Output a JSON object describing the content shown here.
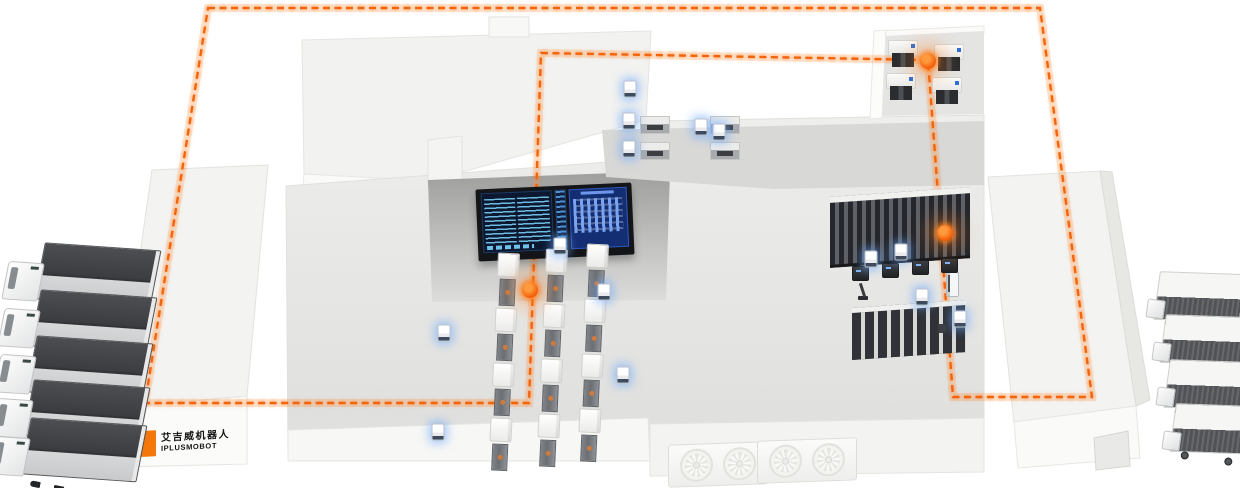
{
  "scene": {
    "width": 1240,
    "height": 488,
    "background": "#ffffff"
  },
  "palette": {
    "route_orange": "#f4640a",
    "route_glow": "#ff8a2a",
    "agv_glow_blue": "#6aa7ff",
    "building_light": "#f3f3f1",
    "floor_gray": "#e6e6e4",
    "control_wall_gray": "#a2a2a0",
    "machine_dark": "#3a3d42",
    "screen_navy": "#0b1830",
    "screen_blue": "#142e74",
    "screen_cyan": "#6fc2ec",
    "logo_orange": "#f4770b"
  },
  "logo": {
    "icon": "orange-blocks-logo",
    "line1": "艾吉威机器人",
    "line2": "IPLUSMOBOT"
  },
  "route": {
    "closed": true,
    "dash_pattern": "7 4.5",
    "points": [
      [
        208,
        8
      ],
      [
        1040,
        8
      ],
      [
        1092,
        397
      ],
      [
        953,
        397
      ],
      [
        928,
        60
      ],
      [
        541,
        53
      ],
      [
        529,
        403
      ],
      [
        145,
        403
      ]
    ],
    "waypoints": [
      {
        "name": "assembly-area-node",
        "x": 530,
        "y": 290
      },
      {
        "name": "storage-rack-node",
        "x": 945,
        "y": 233
      },
      {
        "name": "machining-room-node",
        "x": 928,
        "y": 61
      }
    ]
  },
  "fleet": {
    "left_dock_trucks": [
      {
        "x": 6,
        "y": 243
      },
      {
        "x": 2,
        "y": 290
      },
      {
        "x": -2,
        "y": 336
      },
      {
        "x": -5,
        "y": 380
      },
      {
        "x": -8,
        "y": 418
      }
    ],
    "right_dock_trucks": [
      {
        "x": 1148,
        "y": 272
      },
      {
        "x": 1154,
        "y": 315
      },
      {
        "x": 1158,
        "y": 360
      },
      {
        "x": 1164,
        "y": 404
      }
    ],
    "agvs": [
      {
        "x": 560,
        "y": 246
      },
      {
        "x": 444,
        "y": 333
      },
      {
        "x": 438,
        "y": 432
      },
      {
        "x": 604,
        "y": 292
      },
      {
        "x": 623,
        "y": 375
      },
      {
        "x": 719,
        "y": 132
      },
      {
        "x": 630,
        "y": 89
      },
      {
        "x": 901,
        "y": 252
      },
      {
        "x": 922,
        "y": 297
      },
      {
        "x": 960,
        "y": 319
      },
      {
        "x": 871,
        "y": 259
      },
      {
        "x": 629,
        "y": 121
      },
      {
        "x": 629,
        "y": 149
      },
      {
        "x": 701,
        "y": 127
      }
    ]
  },
  "production_area": {
    "stations_per_line": 4,
    "lines": [
      {
        "x": 497,
        "y": 253
      },
      {
        "x": 545,
        "y": 249
      },
      {
        "x": 586,
        "y": 244
      }
    ]
  },
  "mezzanine": {
    "machines": [
      {
        "x": 640,
        "y": 116
      },
      {
        "x": 710,
        "y": 116
      },
      {
        "x": 640,
        "y": 142
      },
      {
        "x": 710,
        "y": 142
      }
    ]
  },
  "machining_room": {
    "machines": [
      {
        "x": 888,
        "y": 40
      },
      {
        "x": 934,
        "y": 44
      },
      {
        "x": 886,
        "y": 73
      },
      {
        "x": 932,
        "y": 77
      }
    ]
  },
  "storage_area": {
    "pick_stations": [
      {
        "x": 852,
        "y": 266
      },
      {
        "x": 882,
        "y": 263
      },
      {
        "x": 912,
        "y": 260
      },
      {
        "x": 941,
        "y": 258
      }
    ]
  },
  "hvac": {
    "fans_per_unit": 2,
    "units": [
      {
        "x": 668,
        "y": 443
      },
      {
        "x": 757,
        "y": 439
      }
    ]
  }
}
